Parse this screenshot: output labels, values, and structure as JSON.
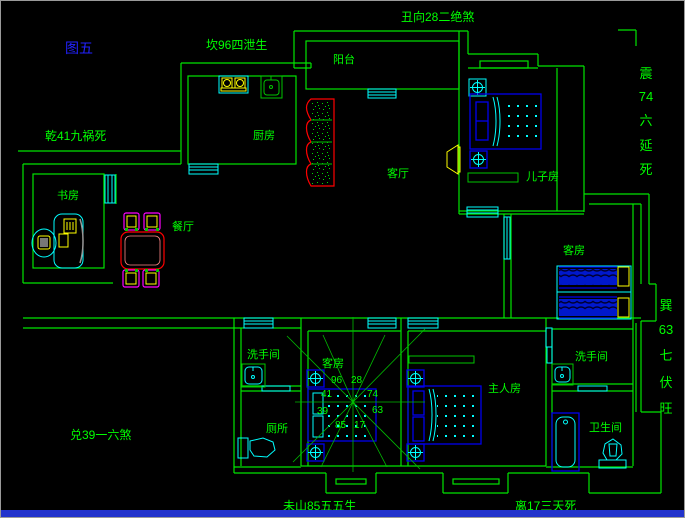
{
  "figure_label": "图五",
  "annotations": {
    "top_center": "丑向28二绝煞",
    "top_left": "坎96四泄生",
    "left_upper": "乾41九祸死",
    "left_lower": "兑39一六煞",
    "bottom_left": "未山85五五生",
    "bottom_right": "离17三天死",
    "right_upper_vertical": [
      "震",
      "74",
      "六",
      "延",
      "死"
    ],
    "right_lower_vertical": [
      "巽",
      "63",
      "七",
      "伏",
      "旺"
    ]
  },
  "rooms": {
    "balcony": "阳台",
    "kitchen": "厨房",
    "living_room": "客厅",
    "son_room": "儿子房",
    "study": "书房",
    "dining": "餐厅",
    "guest_room_right": "客房",
    "guest_room_small": "客房",
    "washroom_left": "洗手间",
    "toilet_room": "厕所",
    "master_room": "主人房",
    "washroom_right": "洗手间",
    "bathroom": "卫生间"
  },
  "compass_numbers": {
    "nw": "96",
    "ne": "28",
    "w_upper": "41",
    "e_upper": "74",
    "w_lower": "39",
    "e_lower": "63",
    "sw": "85",
    "se": "17"
  },
  "colors": {
    "background": "#000000",
    "wall_green": "#00e400",
    "text_green": "#00ff00",
    "furniture_cyan": "#00ffff",
    "furniture_blue": "#0000ee",
    "accent_yellow": "#ffff00",
    "accent_red": "#ff0000",
    "accent_magenta": "#ff00ff",
    "figure_label_blue": "#2222ff",
    "bottom_bar_blue": "#2233cc"
  }
}
